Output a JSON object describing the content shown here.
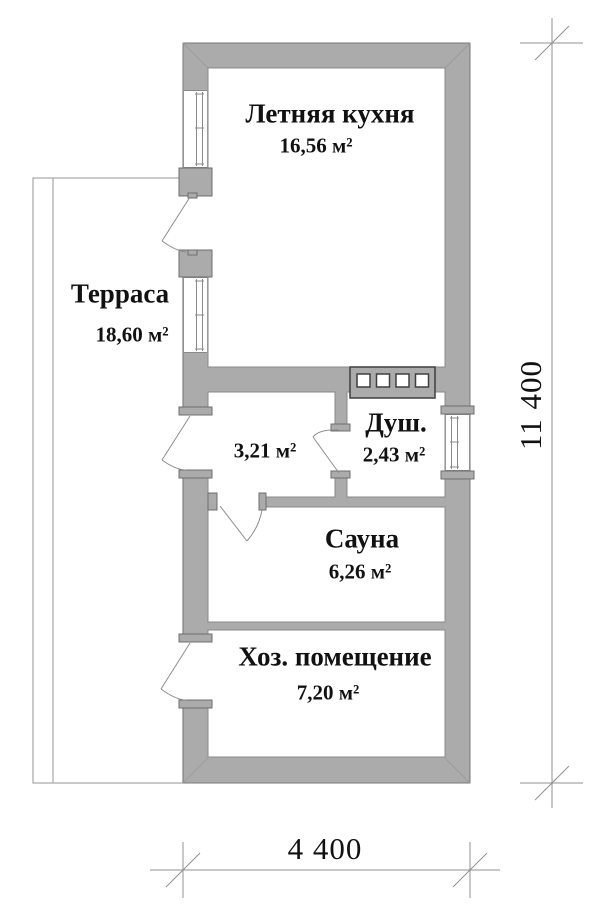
{
  "rooms": {
    "kitchen": {
      "name": "Летняя кухня",
      "area": "16,56 м²"
    },
    "terrace": {
      "name": "Терраса",
      "area": "18,60 м²"
    },
    "hallway": {
      "area": "3,21 м²"
    },
    "shower": {
      "name": "Душ.",
      "area": "2,43 м²"
    },
    "sauna": {
      "name": "Сауна",
      "area": "6,26 м²"
    },
    "utility": {
      "name": "Хоз. помещение",
      "area": "7,20 м²"
    }
  },
  "dimensions": {
    "vertical": "11 400",
    "horizontal": "4 400"
  },
  "colors": {
    "wall_fill": "#ababab",
    "wall_outline": "#777777",
    "dimension_line": "#909090",
    "text": "#111111"
  }
}
